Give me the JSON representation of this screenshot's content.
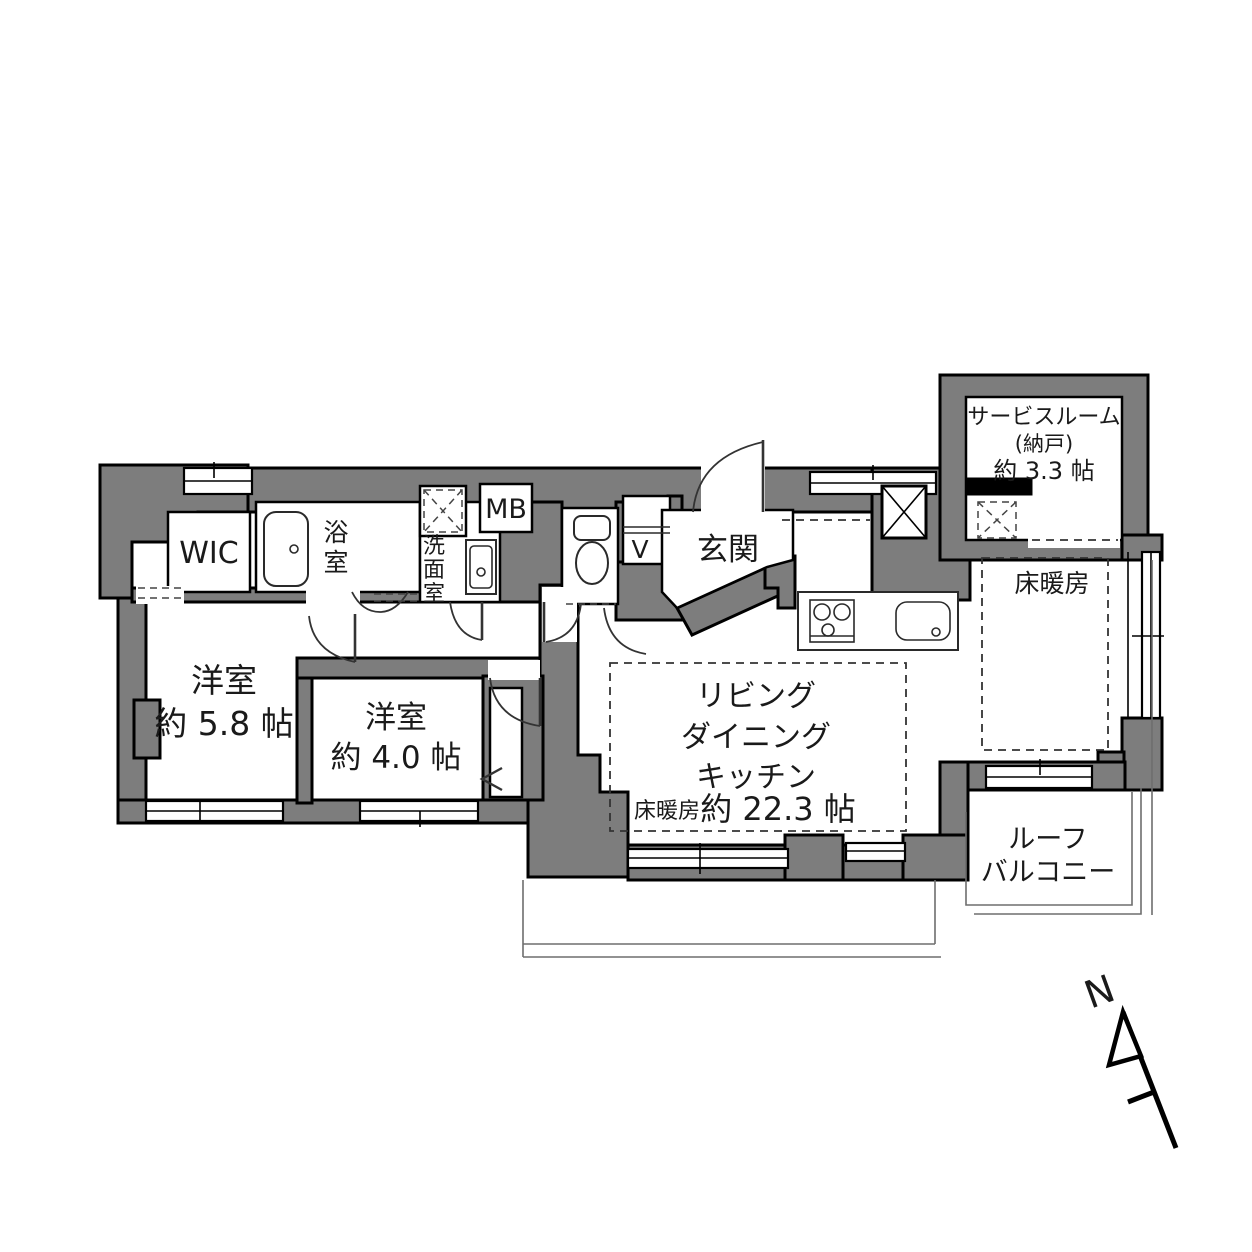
{
  "meta": {
    "kind": "apartment-floorplan"
  },
  "colors": {
    "wall_fill": "#7d7d7d",
    "outline": "#000000",
    "background": "#ffffff"
  },
  "rooms": {
    "wic": {
      "label": "WIC"
    },
    "bathroom": {
      "c1": "浴",
      "c2": "室"
    },
    "washroom": {
      "c1": "洗",
      "c2": "面",
      "c3": "室"
    },
    "meter_box": {
      "label": "MB"
    },
    "shoe_box": {
      "label": "V"
    },
    "entrance": {
      "label": "玄関"
    },
    "service_room": {
      "line1": "サービスルーム",
      "line2": "(納戸)",
      "line3": "約 3.3 帖"
    },
    "floor_heating_zone": {
      "label": "床暖房"
    },
    "bedroom_58": {
      "name": "洋室",
      "size": "約 5.8 帖"
    },
    "bedroom_40": {
      "name": "洋室",
      "size": "約 4.0 帖"
    },
    "ldk": {
      "line1": "リビング",
      "line2": "ダイニング",
      "line3": "キッチン",
      "heating": "床暖房",
      "size": "約 22.3 帖"
    },
    "roof_balcony": {
      "line1": "ルーフ",
      "line2": "バルコニー"
    }
  },
  "compass": {
    "label": "N"
  }
}
